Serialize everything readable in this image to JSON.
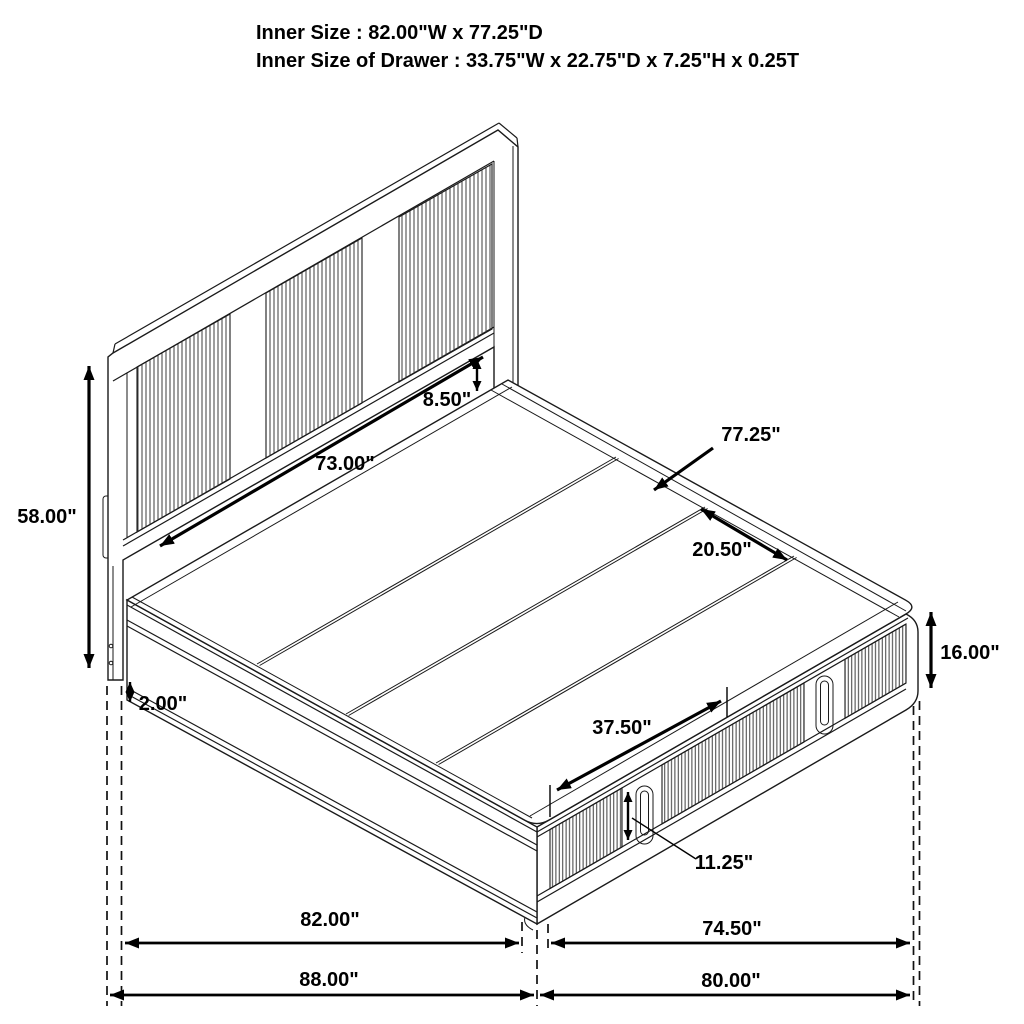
{
  "title_block": {
    "line1": "Inner Size : 82.00\"W x 77.25\"D",
    "line2": "Inner Size of Drawer : 33.75\"W x 22.75\"D x 7.25\"H x 0.25T"
  },
  "dims": {
    "hb_height": "58.00\"",
    "clearance": "2.00\"",
    "hb_inner_width": "73.00\"",
    "deck_gap": "8.50\"",
    "inner_depth": "77.25\"",
    "panel_width": "20.50\"",
    "fb_height": "16.00\"",
    "drawer_width": "37.50\"",
    "drawer_front_height": "11.25\"",
    "width_inner": "82.00\"",
    "depth_inner": "74.50\"",
    "width_overall": "88.00\"",
    "depth_overall": "80.00\""
  }
}
